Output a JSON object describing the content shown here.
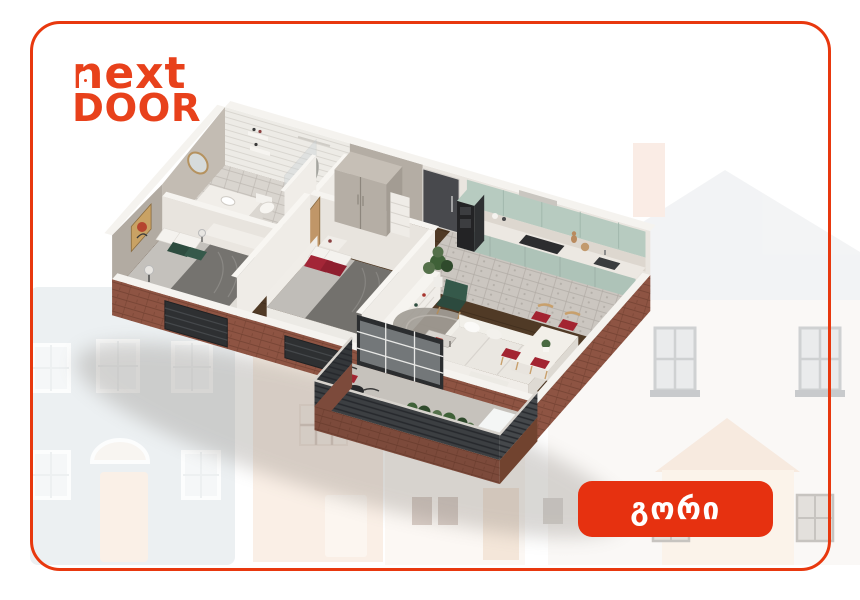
{
  "brand": {
    "line1": "next",
    "line2": "DOOR"
  },
  "location_badge": {
    "label": "გორი"
  },
  "palette": {
    "brand_red": "#e8411b",
    "badge_red": "#e63110",
    "frame_red": "#e8380e",
    "brick": "#8e5443",
    "wood_floor": "#4f3724",
    "kitchen_cabinet_mint": "#b7cbc0",
    "balcony_slat": "#3c3f42",
    "accent_red": "#a32431",
    "interior_wall_beige": "#b2aba2",
    "white_trim": "#f5f3ef"
  },
  "floorplan": {
    "type": "3d-isometric-apartment-cutaway",
    "rooms": [
      "bathroom",
      "bedroom-1",
      "bedroom-2",
      "hallway",
      "kitchen",
      "living-room",
      "balcony"
    ]
  },
  "background": {
    "style": "faded-illustrated-houses"
  }
}
